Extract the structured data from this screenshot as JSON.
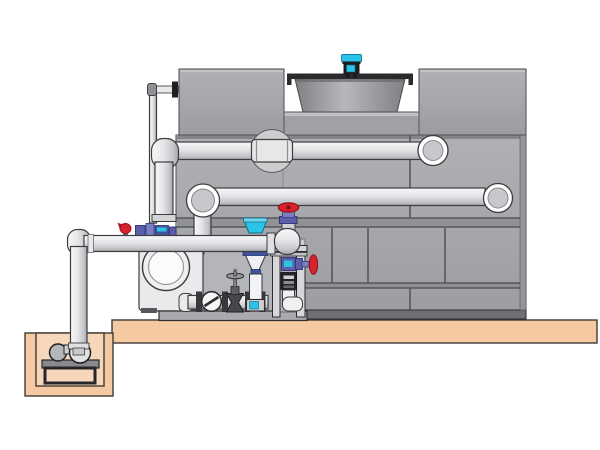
{
  "title": "Cooling tower water system installation diagram",
  "colors": {
    "bg": "#ffffff",
    "tank": "#a6a8ab",
    "seam": "#55575a",
    "band": "#6f7073",
    "slab": "#f5c9a1",
    "pit": "#f7d7ba",
    "pipe": "#e9eaec",
    "outline": "#3c3d3f",
    "cyan": "#2cc3e8",
    "red": "#d8232f",
    "red-dark": "#8e1219",
    "purple": "#5b5fa8",
    "purple-light": "#7b7fc0",
    "navy": "#4053a0",
    "steel": "#d6d7d9",
    "dark": "#232427"
  },
  "components": [
    {
      "name": "cooling-tower",
      "desc": "gray panelled cooling tower casing"
    },
    {
      "name": "fan-motor",
      "desc": "cyan fan motor on tower roof"
    },
    {
      "name": "fan-shroud",
      "desc": "fan drum/venturi on tower roof"
    },
    {
      "name": "upper-distribution-pipe",
      "desc": "horizontal pipe with coupling entering upper tower face"
    },
    {
      "name": "lower-return-pipe",
      "desc": "horizontal pipe entering mid tower face"
    },
    {
      "name": "riser-pipe",
      "desc": "vertical pipe from upper pipe elbow down to fittings"
    },
    {
      "name": "makeup-water-pipe",
      "desc": "thin pipe entering tower upper left"
    },
    {
      "name": "pump-discharge-pipe",
      "desc": "main horizontal pipe from sump riser to elbow valve"
    },
    {
      "name": "sump-discharge-pipe",
      "desc": "vertical pipe rising from sump pit pump"
    },
    {
      "name": "sump-pit",
      "desc": "below-grade pit with pump on stand"
    },
    {
      "name": "sump-pump",
      "desc": "horizontal pump set in pit"
    },
    {
      "name": "centrifugal-pump",
      "desc": "end-suction pump with circular inlet"
    },
    {
      "name": "check-valve",
      "desc": "wafer check valve on bottom manifold"
    },
    {
      "name": "gate-valve",
      "desc": "dark gate valve with tee handle"
    },
    {
      "name": "tundish-drain",
      "desc": "blue-capped funnel drain assembly"
    },
    {
      "name": "control-tower",
      "desc": "frame rack with solenoid valve, controller and elbow pipe"
    },
    {
      "name": "red-handwheel-valve-top",
      "desc": "globe valve with red handwheel on pipe-end elbow"
    },
    {
      "name": "red-handwheel-valve-side",
      "desc": "side-mounted valve with red handwheel"
    },
    {
      "name": "red-mini-valve",
      "desc": "small red valve on discharge pipe"
    },
    {
      "name": "blue-fittings",
      "desc": "blue meter/valve fittings on discharge pipe"
    },
    {
      "name": "equipment-skid",
      "desc": "steel skid base under pump and manifold"
    },
    {
      "name": "concrete-slab",
      "desc": "tan housekeeping pad"
    }
  ]
}
